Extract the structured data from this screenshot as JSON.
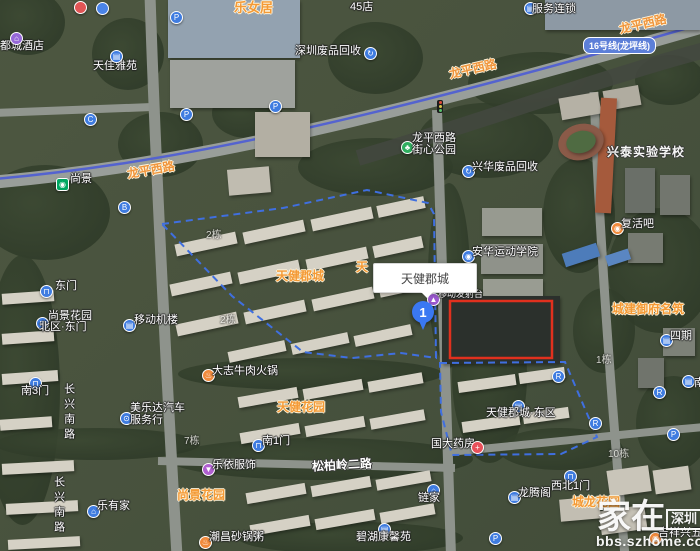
{
  "map": {
    "popup_text": "天健郡城",
    "marker_label": "1",
    "metro_line_badge": "16号线(龙坪线)",
    "watermark": {
      "brand": "家在",
      "brand_badge": "深圳",
      "url": "bbs.szhome.com"
    },
    "colors": {
      "poi_blue": "#3f7ce0",
      "label_orange": "#f49a36",
      "boundary_blue": "#3f6fe0",
      "highlight_red": "#e0301e",
      "metro_line": "#5463cf",
      "metro_station_green": "#00a862"
    },
    "items": [
      {
        "kind": "text",
        "name": "label-ducheng-hotel",
        "text": "都城酒店",
        "x": 0,
        "y": 40,
        "cls": "t-white",
        "inter": true
      },
      {
        "kind": "icon",
        "name": "hotel-icon",
        "x": 10,
        "y": 32,
        "bg": "#9668d8",
        "glyph": "⌂",
        "inter": true
      },
      {
        "kind": "text",
        "name": "label-tianjia-yayuan",
        "text": "天佳雅苑",
        "x": 93,
        "y": 60,
        "cls": "t-white",
        "inter": true
      },
      {
        "kind": "icon",
        "name": "building-icon-tianjia",
        "x": 110,
        "y": 50,
        "bg": "#3f7ce0",
        "glyph": "▤",
        "inter": true
      },
      {
        "kind": "text",
        "name": "label-lenvju",
        "text": "乐女居",
        "x": 234,
        "y": 1,
        "cls": "t-orange",
        "fs": 13,
        "inter": true
      },
      {
        "kind": "icon",
        "name": "poi-icon-partial-red",
        "x": 74,
        "y": 1,
        "bg": "#e05555",
        "glyph": "",
        "inter": true
      },
      {
        "kind": "icon",
        "name": "poi-icon-partial-blue",
        "x": 96,
        "y": 2,
        "bg": "#4a84e8",
        "glyph": "",
        "inter": true
      },
      {
        "kind": "text",
        "name": "label-45-store-partial",
        "text": "45店",
        "x": 350,
        "y": 1,
        "cls": "t-white",
        "inter": true
      },
      {
        "kind": "icon",
        "name": "chain-store-icon",
        "x": 524,
        "y": 2,
        "bg": "#3f7ce0",
        "glyph": "▤",
        "inter": true
      },
      {
        "kind": "text",
        "name": "label-fuwu-liansuo",
        "text": "服务连锁",
        "x": 532,
        "y": 3,
        "cls": "t-white",
        "inter": true
      },
      {
        "kind": "text",
        "name": "label-shenzhen-recycle",
        "text": "深圳废品回收",
        "x": 295,
        "y": 45,
        "cls": "t-white",
        "inter": true
      },
      {
        "kind": "icon",
        "name": "recycle-icon-1",
        "x": 364,
        "y": 47,
        "bg": "#3f7ce0",
        "glyph": "↻",
        "inter": true
      },
      {
        "kind": "icon",
        "name": "parking-icon-1",
        "x": 170,
        "y": 11,
        "bg": "#3f7ce0",
        "glyph": "P",
        "inter": true
      },
      {
        "kind": "icon",
        "name": "parking-icon-2",
        "x": 180,
        "y": 108,
        "bg": "#3f7ce0",
        "glyph": "P",
        "inter": true
      },
      {
        "kind": "icon",
        "name": "parking-icon-3",
        "x": 269,
        "y": 100,
        "bg": "#3f7ce0",
        "glyph": "P",
        "inter": true
      },
      {
        "kind": "icon",
        "name": "parking-icon-4",
        "x": 667,
        "y": 428,
        "bg": "#3f7ce0",
        "glyph": "P",
        "inter": true
      },
      {
        "kind": "icon",
        "name": "parking-icon-5",
        "x": 489,
        "y": 532,
        "bg": "#3f7ce0",
        "glyph": "P",
        "inter": true
      },
      {
        "kind": "icon",
        "name": "exit-c-icon",
        "x": 84,
        "y": 113,
        "bg": "#3f7ce0",
        "glyph": "C",
        "inter": true
      },
      {
        "kind": "icon",
        "name": "exit-b-icon",
        "x": 118,
        "y": 201,
        "bg": "#3f7ce0",
        "glyph": "B",
        "inter": true
      },
      {
        "kind": "icon",
        "name": "entrance-r-icon-1",
        "x": 552,
        "y": 370,
        "bg": "#3f7ce0",
        "glyph": "R",
        "inter": true
      },
      {
        "kind": "icon",
        "name": "entrance-r-icon-2",
        "x": 653,
        "y": 386,
        "bg": "#3f7ce0",
        "glyph": "R",
        "inter": true
      },
      {
        "kind": "icon",
        "name": "entrance-r-icon-3",
        "x": 589,
        "y": 417,
        "bg": "#3f7ce0",
        "glyph": "R",
        "inter": true
      },
      {
        "kind": "icon",
        "name": "metro-station-icon",
        "x": 56,
        "y": 178,
        "bg": "#00a862",
        "glyph": "◉",
        "square": true,
        "inter": true
      },
      {
        "kind": "text",
        "name": "label-shangjing-station",
        "text": "尚景",
        "x": 70,
        "y": 173,
        "cls": "t-white",
        "inter": true
      },
      {
        "kind": "text",
        "name": "road-label-longping-west-1",
        "text": "龙平西路",
        "x": 127,
        "y": 164,
        "cls": "t-road",
        "rot": -10,
        "inter": false
      },
      {
        "kind": "text",
        "name": "road-label-longping-west-2",
        "text": "龙平西路",
        "x": 449,
        "y": 63,
        "cls": "t-road",
        "rot": -13,
        "inter": false
      },
      {
        "kind": "text",
        "name": "road-label-longping-west-3",
        "text": "龙平西路",
        "x": 619,
        "y": 18,
        "cls": "t-road",
        "rot": -13,
        "inter": false
      },
      {
        "kind": "text",
        "name": "road-label-changxing-south-1",
        "text": "长兴南路",
        "x": 62,
        "y": 383,
        "cls": "t-white t-vert",
        "inter": false
      },
      {
        "kind": "text",
        "name": "road-label-changxing-south-2",
        "text": "长兴南路",
        "x": 52,
        "y": 476,
        "cls": "t-white t-vert",
        "inter": false
      },
      {
        "kind": "text",
        "name": "road-label-songbailing-2nd",
        "text": "松柏岭二路",
        "x": 312,
        "y": 459,
        "cls": "t-roadwhite",
        "rot": -3,
        "inter": false
      },
      {
        "kind": "icon",
        "name": "gate-icon-east",
        "x": 40,
        "y": 285,
        "bg": "#3f7ce0",
        "glyph": "⊓",
        "inter": true
      },
      {
        "kind": "text",
        "name": "label-east-gate",
        "text": "东门",
        "x": 55,
        "y": 280,
        "cls": "t-white",
        "inter": true
      },
      {
        "kind": "icon",
        "name": "gate-icon-north-east",
        "x": 36,
        "y": 317,
        "bg": "#3f7ce0",
        "glyph": "⊓",
        "inter": true
      },
      {
        "kind": "text",
        "name": "label-shangjing-north-line1",
        "text": "尚景花园",
        "x": 48,
        "y": 310,
        "cls": "t-white",
        "inter": true
      },
      {
        "kind": "text",
        "name": "label-shangjing-north-line2",
        "text": "北区·东门",
        "x": 39,
        "y": 321,
        "cls": "t-white",
        "inter": true
      },
      {
        "kind": "icon",
        "name": "building-icon-yidong",
        "x": 123,
        "y": 319,
        "bg": "#3f7ce0",
        "glyph": "▤",
        "inter": true
      },
      {
        "kind": "text",
        "name": "label-yidong-jilou",
        "text": "移动机楼",
        "x": 134,
        "y": 314,
        "cls": "t-white",
        "inter": true
      },
      {
        "kind": "icon",
        "name": "restaurant-icon-dazhi",
        "x": 202,
        "y": 369,
        "bg": "#f08a3c",
        "glyph": "♨",
        "inter": true
      },
      {
        "kind": "text",
        "name": "label-dazhi-beef-hotpot",
        "text": "大志牛肉火锅",
        "x": 212,
        "y": 365,
        "cls": "t-white",
        "inter": true
      },
      {
        "kind": "icon",
        "name": "gate-icon-south3",
        "x": 29,
        "y": 377,
        "bg": "#3f7ce0",
        "glyph": "⊓",
        "inter": true
      },
      {
        "kind": "text",
        "name": "label-south-gate-3",
        "text": "南3门",
        "x": 21,
        "y": 385,
        "cls": "t-white",
        "inter": true
      },
      {
        "kind": "icon",
        "name": "car-icon-meileda",
        "x": 120,
        "y": 412,
        "bg": "#3f7ce0",
        "glyph": "⊙",
        "inter": true
      },
      {
        "kind": "text",
        "name": "label-meileda-line1",
        "text": "美乐达汽车",
        "x": 130,
        "y": 402,
        "cls": "t-white",
        "inter": true
      },
      {
        "kind": "text",
        "name": "label-meileda-line2",
        "text": "服务行",
        "x": 130,
        "y": 414,
        "cls": "t-white",
        "inter": true
      },
      {
        "kind": "icon",
        "name": "clothes-icon-leyi",
        "x": 202,
        "y": 463,
        "bg": "#b05fd0",
        "glyph": "▼",
        "inter": true
      },
      {
        "kind": "text",
        "name": "label-leyi-fushi",
        "text": "乐依服饰",
        "x": 212,
        "y": 459,
        "cls": "t-white",
        "inter": true
      },
      {
        "kind": "text",
        "name": "label-shangjing-garden",
        "text": "尚景花园",
        "x": 177,
        "y": 489,
        "cls": "t-orange",
        "inter": true
      },
      {
        "kind": "icon",
        "name": "house-icon-leyoujia",
        "x": 87,
        "y": 505,
        "bg": "#3f7ce0",
        "glyph": "⌂",
        "inter": true
      },
      {
        "kind": "text",
        "name": "label-leyoujia",
        "text": "乐有家",
        "x": 97,
        "y": 500,
        "cls": "t-white",
        "inter": true
      },
      {
        "kind": "icon",
        "name": "restaurant-icon-chaochang",
        "x": 199,
        "y": 536,
        "bg": "#f08a3c",
        "glyph": "♨",
        "inter": true
      },
      {
        "kind": "text",
        "name": "label-chaochang-congee",
        "text": "潮昌砂锅粥",
        "x": 209,
        "y": 531,
        "cls": "t-white",
        "inter": true
      },
      {
        "kind": "text",
        "name": "label-tianjian-garden",
        "text": "天健花园",
        "x": 277,
        "y": 401,
        "cls": "t-orange",
        "inter": true
      },
      {
        "kind": "icon",
        "name": "gate-icon-south1",
        "x": 252,
        "y": 439,
        "bg": "#3f7ce0",
        "glyph": "⊓",
        "inter": true
      },
      {
        "kind": "text",
        "name": "label-south-gate-1",
        "text": "南1门",
        "x": 262,
        "y": 435,
        "cls": "t-white",
        "inter": true
      },
      {
        "kind": "text",
        "name": "label-guoda-pharmacy",
        "text": "国大药房",
        "x": 431,
        "y": 438,
        "cls": "t-white",
        "inter": true
      },
      {
        "kind": "icon",
        "name": "pharmacy-icon-guoda",
        "x": 471,
        "y": 441,
        "bg": "#e8505a",
        "glyph": "+",
        "inter": true
      },
      {
        "kind": "icon",
        "name": "house-icon-lianjia",
        "x": 427,
        "y": 484,
        "bg": "#3f7ce0",
        "glyph": "⌂",
        "inter": true
      },
      {
        "kind": "text",
        "name": "label-lianjia",
        "text": "链家",
        "x": 418,
        "y": 492,
        "cls": "t-white",
        "inter": true
      },
      {
        "kind": "icon",
        "name": "building-icon-bihu",
        "x": 378,
        "y": 523,
        "bg": "#3f7ce0",
        "glyph": "▤",
        "inter": true
      },
      {
        "kind": "text",
        "name": "label-bihu-kangxin",
        "text": "碧湖康馨苑",
        "x": 356,
        "y": 531,
        "cls": "t-white",
        "inter": true
      },
      {
        "kind": "icon",
        "name": "building-icon-dongqu",
        "x": 512,
        "y": 400,
        "bg": "#3f7ce0",
        "glyph": "▤",
        "inter": true
      },
      {
        "kind": "text",
        "name": "label-tianjian-east",
        "text": "天健郡城·东区",
        "x": 486,
        "y": 407,
        "cls": "t-white",
        "inter": true
      },
      {
        "kind": "icon",
        "name": "building-icon-siqi",
        "x": 660,
        "y": 334,
        "bg": "#3f7ce0",
        "glyph": "▤",
        "inter": true
      },
      {
        "kind": "text",
        "name": "label-siqi",
        "text": "四期",
        "x": 670,
        "y": 330,
        "cls": "t-white",
        "inter": true
      },
      {
        "kind": "icon",
        "name": "sports-icon-anhua",
        "x": 462,
        "y": 250,
        "bg": "#3f7ce0",
        "glyph": "◉",
        "inter": true
      },
      {
        "kind": "text",
        "name": "label-anhua-sports-academy",
        "text": "安华运动学院",
        "x": 472,
        "y": 246,
        "cls": "t-white",
        "inter": true
      },
      {
        "kind": "icon",
        "name": "recycle-icon-xinghua",
        "x": 462,
        "y": 165,
        "bg": "#3f7ce0",
        "glyph": "↻",
        "inter": true
      },
      {
        "kind": "text",
        "name": "label-xinghua-recycle",
        "text": "兴华废品回收",
        "x": 472,
        "y": 161,
        "cls": "t-white",
        "inter": true
      },
      {
        "kind": "icon",
        "name": "park-icon",
        "x": 401,
        "y": 141,
        "bg": "#2fae5f",
        "glyph": "♣",
        "inter": true
      },
      {
        "kind": "text",
        "name": "label-park-line1",
        "text": "龙平西路",
        "x": 412,
        "y": 132,
        "cls": "t-white",
        "inter": true
      },
      {
        "kind": "text",
        "name": "label-park-line2",
        "text": "街心公园",
        "x": 412,
        "y": 144,
        "cls": "t-white",
        "inter": true
      },
      {
        "kind": "text",
        "name": "label-xingtai-school",
        "text": "兴泰实验学校",
        "x": 607,
        "y": 146,
        "cls": "t-school",
        "inter": true
      },
      {
        "kind": "icon",
        "name": "bar-icon-fuhuo",
        "x": 611,
        "y": 222,
        "bg": "#f08a3c",
        "glyph": "◉",
        "inter": true
      },
      {
        "kind": "text",
        "name": "label-fuhuoba",
        "text": "复活吧",
        "x": 621,
        "y": 218,
        "cls": "t-white",
        "inter": true
      },
      {
        "kind": "text",
        "name": "label-chengjian-yufu",
        "text": "城建御府名筑",
        "x": 612,
        "y": 303,
        "cls": "t-orange",
        "inter": true
      },
      {
        "kind": "text",
        "name": "label-chenglong-garden",
        "text": "城龙花园",
        "x": 572,
        "y": 496,
        "cls": "t-orange",
        "inter": true
      },
      {
        "kind": "icon",
        "name": "building-icon-longteng",
        "x": 508,
        "y": 491,
        "bg": "#3f7ce0",
        "glyph": "▤",
        "inter": true
      },
      {
        "kind": "text",
        "name": "label-longtengge",
        "text": "龙腾阁",
        "x": 518,
        "y": 487,
        "cls": "t-white",
        "inter": true
      },
      {
        "kind": "icon",
        "name": "gate-icon-northwest1",
        "x": 564,
        "y": 470,
        "bg": "#3f7ce0",
        "glyph": "⊓",
        "inter": true
      },
      {
        "kind": "text",
        "name": "label-northwest-gate-1",
        "text": "西北1门",
        "x": 551,
        "y": 480,
        "cls": "t-white",
        "inter": true
      },
      {
        "kind": "icon",
        "name": "shop-icon-jixiang",
        "x": 649,
        "y": 532,
        "bg": "#f08a3c",
        "glyph": "◉",
        "inter": true
      },
      {
        "kind": "text",
        "name": "label-jixiangxing-hardware",
        "text": "吉祥兴五金店",
        "x": 658,
        "y": 527,
        "cls": "t-white",
        "inter": true
      },
      {
        "kind": "icon",
        "name": "antenna-icon",
        "x": 427,
        "y": 293,
        "bg": "#9b59d0",
        "glyph": "▲",
        "inter": true
      },
      {
        "kind": "text",
        "name": "label-fashetai",
        "text": "移动发射台",
        "x": 438,
        "y": 289,
        "cls": "t-white",
        "fs": 9,
        "inter": true
      },
      {
        "kind": "text",
        "name": "label-tianjian-juncheng",
        "text": "天健郡城",
        "x": 276,
        "y": 270,
        "cls": "t-orange",
        "inter": true
      },
      {
        "kind": "text",
        "name": "label-partial-tian",
        "text": "天",
        "x": 356,
        "y": 261,
        "cls": "t-orange",
        "inter": false
      },
      {
        "kind": "text",
        "name": "building-no-2a",
        "text": "2栋",
        "x": 206,
        "y": 230,
        "cls": "t-build",
        "inter": false
      },
      {
        "kind": "text",
        "name": "building-no-2b",
        "text": "2栋",
        "x": 220,
        "y": 315,
        "cls": "t-build",
        "inter": false
      },
      {
        "kind": "text",
        "name": "building-no-7",
        "text": "7栋",
        "x": 184,
        "y": 436,
        "cls": "t-build",
        "inter": false
      },
      {
        "kind": "text",
        "name": "building-no-1",
        "text": "1栋",
        "x": 596,
        "y": 355,
        "cls": "t-build",
        "inter": false
      },
      {
        "kind": "text",
        "name": "building-no-10",
        "text": "10栋",
        "x": 608,
        "y": 449,
        "cls": "t-build",
        "inter": false
      },
      {
        "kind": "icon",
        "name": "poi-icon-edge-right",
        "x": 682,
        "y": 375,
        "bg": "#3f7ce0",
        "glyph": "▤",
        "inter": true
      },
      {
        "kind": "text",
        "name": "label-edge-partial",
        "text": "南",
        "x": 694,
        "y": 377,
        "cls": "t-white",
        "inter": false
      }
    ]
  }
}
